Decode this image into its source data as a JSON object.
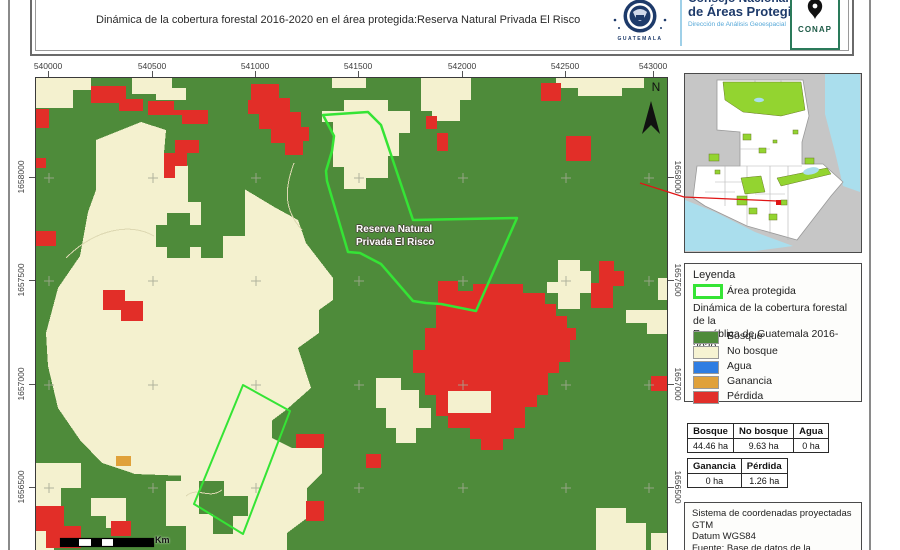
{
  "header": {
    "subtitle": "Dinámica de la cobertura forestal 2016-2020 en el área protegida:Reserva Natural Privada El Risco",
    "seal_text": "GUATEMALA",
    "org": {
      "line1": "Consejo Nacional",
      "line2": "de Áreas Protegidas",
      "line3": "Dirección de Análisis Geoespacial"
    },
    "conap_label": "CONAP"
  },
  "map": {
    "x_ticks": [
      "540000",
      "540500",
      "541000",
      "541500",
      "542000",
      "542500",
      "543000"
    ],
    "y_ticks": [
      "1658000",
      "1657500",
      "1657000",
      "1656500"
    ],
    "reserve_label_line1": "Reserva Natural",
    "reserve_label_line2": "Privada El Risco",
    "north_label": "N",
    "scale_unit": "Km"
  },
  "legend": {
    "title": "Leyenda",
    "area_protegida_label": "Área protegida",
    "subtitle_line1": "Dinámica de la cobertura forestal de la",
    "subtitle_line2": "República de Guatemala 2016-2020",
    "items": [
      {
        "label": "Bosque",
        "color": "#4e8b3a"
      },
      {
        "label": "No bosque",
        "color": "#f6f3d2"
      },
      {
        "label": "Agua",
        "color": "#2e7de2"
      },
      {
        "label": "Ganancia",
        "color": "#e0a13a"
      },
      {
        "label": "Pérdida",
        "color": "#e12f2a"
      }
    ]
  },
  "stats": {
    "table1": {
      "headers": [
        "Bosque",
        "No bosque",
        "Agua"
      ],
      "values": [
        "44.46 ha",
        "9.63 ha",
        "0 ha"
      ]
    },
    "table2": {
      "headers": [
        "Ganancia",
        "Pérdida"
      ],
      "values": [
        "0 ha",
        "1.26 ha"
      ]
    }
  },
  "info": {
    "lines": [
      "Sistema de coordenadas proyectadas",
      "GTM",
      "Datum WGS84",
      "Fuente: Base de datos de la",
      "Dirección de Análisis Geoespacial"
    ]
  },
  "colors": {
    "bosque": "#4e8b3a",
    "no_bosque": "#f4f1cf",
    "agua": "#2e7de2",
    "ganancia": "#e0a13a",
    "perdida": "#e22e28",
    "area_protegida_outline": "#35e435",
    "locator_red": "#e01515",
    "inset_protected_green": "#93d430",
    "inset_water": "#aadeed"
  }
}
